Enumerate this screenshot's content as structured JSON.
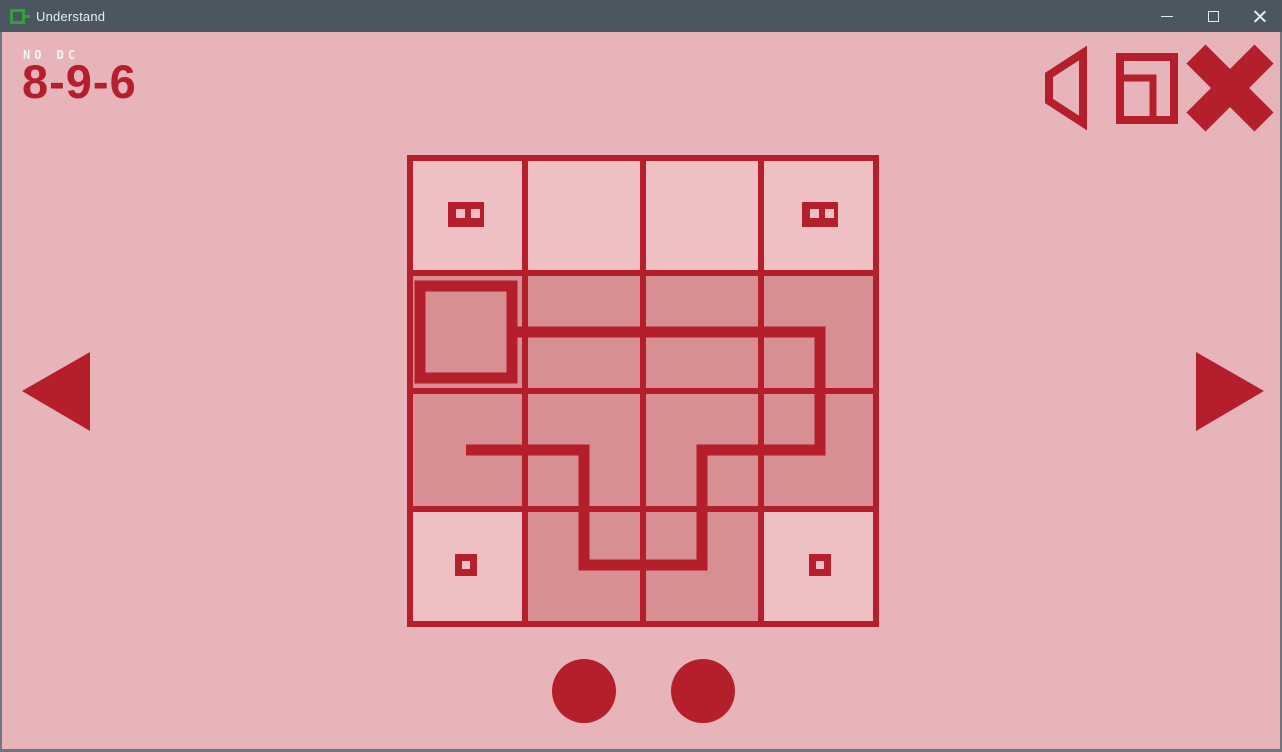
{
  "window": {
    "title": "Understand",
    "controls": {
      "minimize": "minimize",
      "maximize": "maximize",
      "close": "close"
    }
  },
  "hud": {
    "mode_label": "NO DC",
    "puzzle_id": "8-9-6"
  },
  "toolbar_icons": [
    {
      "name": "speaker-mute-icon"
    },
    {
      "name": "window-mode-icon"
    },
    {
      "name": "exit-cross-icon"
    }
  ],
  "navigation": {
    "previous": "previous-puzzle-arrow",
    "next": "next-puzzle-arrow"
  },
  "board": {
    "rows": 4,
    "cols": 4,
    "cell_px": 118,
    "grid_line_px": 6,
    "path_line_px": 11,
    "visited": [
      [
        false,
        false,
        false,
        false
      ],
      [
        true,
        true,
        true,
        true
      ],
      [
        true,
        true,
        true,
        true
      ],
      [
        false,
        true,
        true,
        false
      ]
    ],
    "start_cell": {
      "row": 1,
      "col": 0
    },
    "path_points": [
      [
        110,
        177
      ],
      [
        413,
        177
      ],
      [
        413,
        295
      ],
      [
        295,
        295
      ],
      [
        295,
        410
      ],
      [
        177,
        410
      ],
      [
        177,
        295
      ],
      [
        59,
        295
      ]
    ],
    "symbols": [
      {
        "row": 0,
        "col": 0,
        "type": "double-square"
      },
      {
        "row": 0,
        "col": 3,
        "type": "double-square"
      },
      {
        "row": 3,
        "col": 0,
        "type": "single-square"
      },
      {
        "row": 3,
        "col": 3,
        "type": "single-square"
      }
    ]
  },
  "footer": {
    "solution_dots": 2
  },
  "colors": {
    "accent_red": "#b41f2b",
    "background": "#e6b4b9",
    "cell_unvisited": "#eec0c4",
    "cell_visited": "#d78f94",
    "titlebar": "#4c5661",
    "titlebar_text": "#e9ebee",
    "window_border": "#70767f",
    "app_icon_green": "#2fa238"
  }
}
